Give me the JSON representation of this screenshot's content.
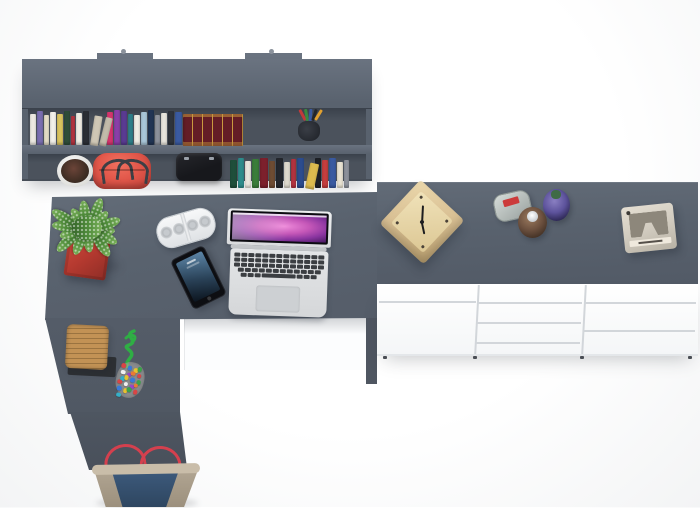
{
  "scene": {
    "type": "top-down 3D product render",
    "objects": [
      "grey wall shelf with two rows of books, white plant pot, red handbag, black camera bag and pen cup",
      "grey L-shaped corner desk with potted plant in red cube pot, white bluetooth speaker, smartphone, open silver laptop, wicker basket and bead charm",
      "white sideboard with grey top holding a wooden cube clock, three small bottles and a beige retro camera",
      "denim tote bag with red handles on the floor"
    ]
  },
  "colors": {
    "surface": "#59626e",
    "surface-light": "#6a7380",
    "surface-dark": "#4b525c",
    "seam": "#d2d6da",
    "maroon-book": "#641d26",
    "gold": "#c99a3f",
    "pot-red": "#b63a30",
    "pot-red-dark": "#8e2d26",
    "plant-green": "#4f8c3a",
    "plant-green-dark": "#35652a",
    "plant-green-light": "#7ab05a",
    "wood-basket": "#c29255",
    "wood-basket-dark": "#9a7340",
    "tray-black": "#2d3034",
    "rope-green": "#2fae44",
    "bag-red": "#e2574a",
    "bag-red-dark": "#c6443c",
    "handle-dark": "#3c3f45",
    "black-item": "#17181c",
    "key-dark": "#3b3e42",
    "screen-pink": "#ee8ada",
    "screen-purple": "#8a35a0",
    "screen-deep": "#33124e",
    "clock-wood": "#d9c094",
    "clock-wood-dark": "#b89e6e",
    "camera-beige": "#d2ccc0",
    "camera-face": "#8d877b",
    "label-red": "#cc3b3b",
    "bottle-brown": "#6e5240",
    "bottle-brown-dark": "#3c2c21",
    "bottle-purple": "#5d539c",
    "bottle-purple-dark": "#252048",
    "cap-green": "#3f6b46",
    "denim": "#3d5a7c",
    "denim-dark": "#2e4660",
    "canvas": "#b2a693",
    "handle-red": "#d4404e"
  },
  "shelf": {
    "books_top": [
      {
        "w": 6,
        "h": 31,
        "c": "#ece9e1"
      },
      {
        "w": 6,
        "h": 34,
        "c": "#7a6fb0"
      },
      {
        "w": 5,
        "h": 30,
        "c": "#e3dcc6"
      },
      {
        "w": 6,
        "h": 33,
        "c": "#f2f0ea"
      },
      {
        "w": 6,
        "h": 31,
        "c": "#d9c35e"
      },
      {
        "w": 6,
        "h": 34,
        "c": "#2f4d39"
      },
      {
        "w": 4,
        "h": 29,
        "c": "#b23440"
      },
      {
        "w": 6,
        "h": 32,
        "c": "#efece3"
      },
      {
        "w": 6,
        "h": 34,
        "c": "#2b2e35"
      },
      {
        "w": 8,
        "h": 30,
        "c": "#cfc7b5",
        "t": 9
      },
      {
        "w": 7,
        "h": 29,
        "c": "#c2bbaa",
        "t": 14
      },
      {
        "w": 6,
        "h": 33,
        "c": "#d5356e"
      },
      {
        "w": 6,
        "h": 35,
        "c": "#8a3fa8"
      },
      {
        "w": 6,
        "h": 34,
        "c": "#5a3b92"
      },
      {
        "w": 5,
        "h": 31,
        "c": "#2f7f8a"
      },
      {
        "w": 6,
        "h": 30,
        "c": "#eeece4"
      },
      {
        "w": 6,
        "h": 33,
        "c": "#a9c6d8"
      },
      {
        "w": 6,
        "h": 35,
        "c": "#223554"
      },
      {
        "w": 5,
        "h": 30,
        "c": "#8d929c"
      },
      {
        "w": 6,
        "h": 32,
        "c": "#e7e4dc"
      },
      {
        "w": 6,
        "h": 34,
        "c": "#2f343c"
      },
      {
        "w": 7,
        "h": 33,
        "c": "#3a5aa0"
      }
    ],
    "book_set_volumes": 6,
    "books_bottom": [
      {
        "w": 7,
        "h": 28,
        "c": "#1f4f3b"
      },
      {
        "w": 6,
        "h": 30,
        "c": "#2f8c8c"
      },
      {
        "w": 6,
        "h": 27,
        "c": "#e9e6de"
      },
      {
        "w": 7,
        "h": 29,
        "c": "#3a7d3a"
      },
      {
        "w": 8,
        "h": 30,
        "c": "#7c202c"
      },
      {
        "w": 6,
        "h": 27,
        "c": "#6e4c33"
      },
      {
        "w": 7,
        "h": 30,
        "c": "#24272d"
      },
      {
        "w": 6,
        "h": 26,
        "c": "#dcd8cc"
      },
      {
        "w": 5,
        "h": 29,
        "c": "#b23440"
      },
      {
        "w": 7,
        "h": 30,
        "c": "#2c4c8e"
      },
      {
        "w": 9,
        "h": 26,
        "c": "#dcbb4e",
        "t": 12
      },
      {
        "w": 6,
        "h": 30,
        "c": "#1d2026"
      },
      {
        "w": 6,
        "h": 28,
        "c": "#c43e3e"
      },
      {
        "w": 7,
        "h": 30,
        "c": "#3a5aa0"
      },
      {
        "w": 6,
        "h": 26,
        "c": "#e8e2d2"
      },
      {
        "w": 5,
        "h": 28,
        "c": "#8d929c"
      }
    ],
    "pens": [
      {
        "c": "#c23a3a",
        "t": -28
      },
      {
        "c": "#3a8a3f",
        "t": -10
      },
      {
        "c": "#3a5aa0",
        "t": 4
      },
      {
        "c": "#23262b",
        "t": 18
      },
      {
        "c": "#e0a030",
        "t": 32
      }
    ]
  },
  "beads": [
    "#d94545",
    "#3a7ad9",
    "#e8c230",
    "#3aa449",
    "#f0f0f0",
    "#9a45c8",
    "#e87a35",
    "#d94545",
    "#35b0c8",
    "#e8c230",
    "#3a7ad9",
    "#3aa449",
    "#d94545",
    "#f0f0f0",
    "#9a45c8",
    "#e87a35",
    "#3a7ad9",
    "#e8c230",
    "#3aa449",
    "#d94545",
    "#35b0c8"
  ],
  "laptop": {
    "key_rows": [
      13,
      13,
      13,
      12
    ],
    "space_row": [
      6,
      6,
      6,
      34,
      6,
      6,
      6
    ]
  },
  "foliage_leaves": 14
}
